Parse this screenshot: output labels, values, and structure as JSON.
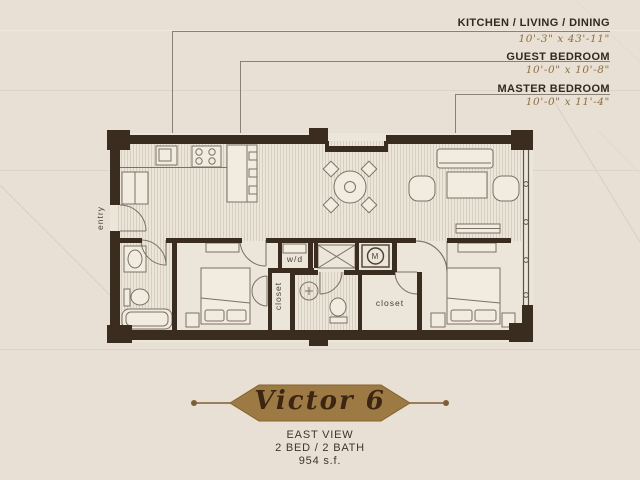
{
  "annotations": [
    {
      "name": "KITCHEN / LIVING / DINING",
      "dims": "10'-3\" x 43'-11\""
    },
    {
      "name": "GUEST BEDROOM",
      "dims": "10'-0\" x 10'-8\""
    },
    {
      "name": "MASTER BEDROOM",
      "dims": "10'-0\" x 11'-4\""
    }
  ],
  "plan": {
    "labels": {
      "entry": "entry",
      "washer_dryer": "w/d",
      "guest_closet": "closet",
      "master_closet": "closet",
      "meter": "M"
    }
  },
  "banner": {
    "title": "Victor 6"
  },
  "footer": {
    "view": "EAST VIEW",
    "config": "2 BED / 2 BATH",
    "area": "954 s.f."
  },
  "colors": {
    "background": "#e8e0d5",
    "wall": "#3a2d20",
    "plan_line": "#7b7166",
    "leader": "#8a8073",
    "label_dark": "#33291d",
    "dims_gold": "#8e6f3e",
    "banner_fill": "#9d7a43",
    "banner_text": "#3b2614"
  }
}
